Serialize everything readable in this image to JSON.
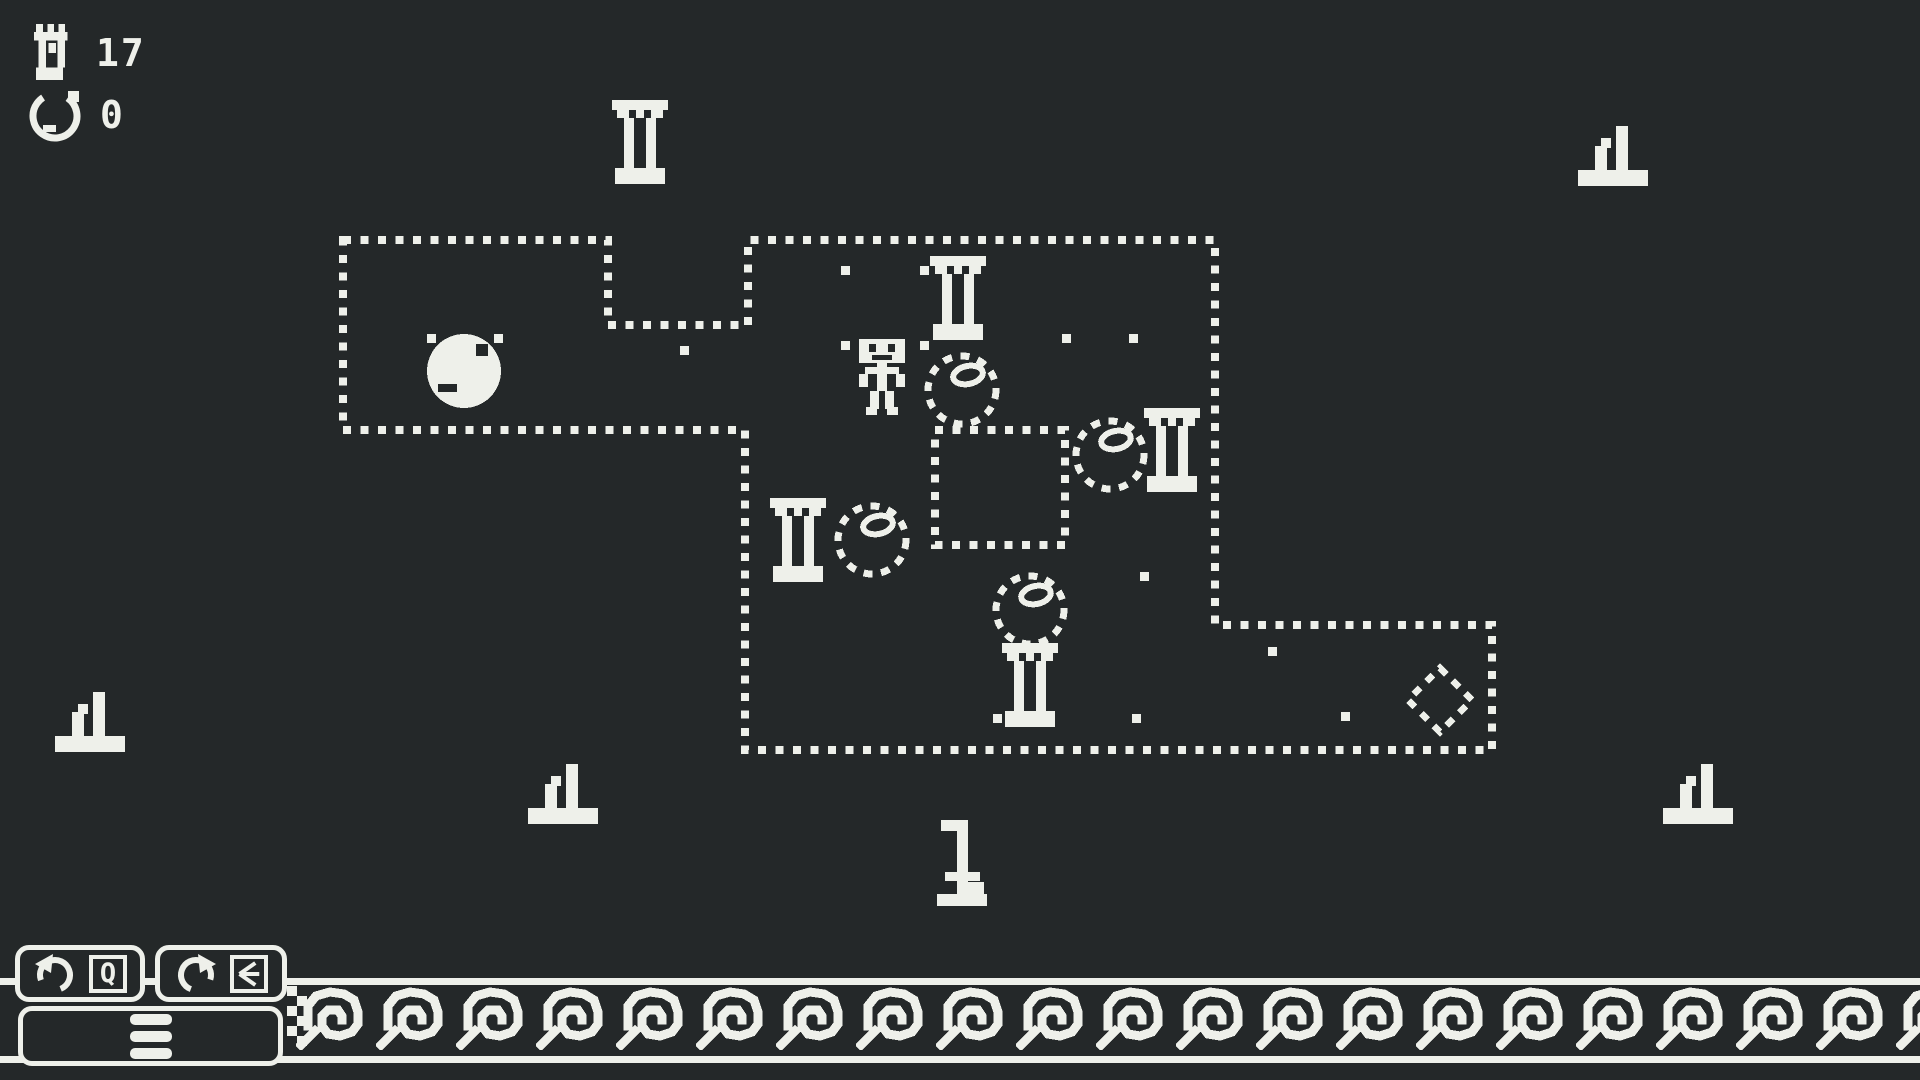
{
  "colors": {
    "background": "#242829",
    "foreground": "#eef0ea"
  },
  "hud": {
    "steps": {
      "icon": "foot-icon",
      "value": "17"
    },
    "undos": {
      "icon": "undo-circle-icon",
      "value": "0"
    }
  },
  "controls": {
    "undo": {
      "icon": "undo-arrow-icon",
      "key_hint": "Q"
    },
    "restart": {
      "icon": "restart-arrow-icon",
      "key_hint_icon": "back-arrow-key-icon"
    },
    "menu": {
      "icon": "hamburger-icon"
    }
  },
  "level": {
    "outline_points": [
      [
        343,
        240
      ],
      [
        608,
        240
      ],
      [
        608,
        325
      ],
      [
        748,
        325
      ],
      [
        748,
        240
      ],
      [
        1215,
        240
      ],
      [
        1215,
        625
      ],
      [
        1492,
        625
      ],
      [
        1492,
        750
      ],
      [
        745,
        750
      ],
      [
        745,
        430
      ],
      [
        343,
        430
      ]
    ],
    "hole": {
      "x": 935,
      "y": 430,
      "w": 130,
      "h": 115
    },
    "dots": [
      [
        427,
        334
      ],
      [
        494,
        334
      ],
      [
        680,
        346
      ],
      [
        841,
        266
      ],
      [
        920,
        266
      ],
      [
        841,
        341
      ],
      [
        920,
        341
      ],
      [
        1062,
        334
      ],
      [
        1129,
        334
      ],
      [
        1140,
        572
      ],
      [
        993,
        714
      ],
      [
        1132,
        714
      ],
      [
        1268,
        647
      ],
      [
        1341,
        712
      ]
    ],
    "objects": [
      {
        "type": "boulder",
        "x": 424,
        "y": 331
      },
      {
        "type": "player",
        "x": 857,
        "y": 339
      },
      {
        "type": "column",
        "x": 930,
        "y": 256
      },
      {
        "type": "ball-goal",
        "x": 922,
        "y": 350
      },
      {
        "type": "column",
        "x": 770,
        "y": 498
      },
      {
        "type": "ball-goal",
        "x": 832,
        "y": 500
      },
      {
        "type": "ball-goal",
        "x": 1070,
        "y": 415
      },
      {
        "type": "column",
        "x": 1144,
        "y": 408
      },
      {
        "type": "ball-goal",
        "x": 990,
        "y": 570
      },
      {
        "type": "column",
        "x": 1002,
        "y": 643
      },
      {
        "type": "diamond-goal",
        "x": 1405,
        "y": 665
      }
    ]
  },
  "decorations": [
    {
      "type": "column",
      "x": 612,
      "y": 100
    },
    {
      "type": "ruin",
      "x": 55,
      "y": 690
    },
    {
      "type": "ruin",
      "x": 528,
      "y": 762
    },
    {
      "type": "ruin",
      "x": 1578,
      "y": 124
    },
    {
      "type": "ruin",
      "x": 1663,
      "y": 762
    },
    {
      "type": "ruin-tall",
      "x": 933,
      "y": 816
    }
  ]
}
